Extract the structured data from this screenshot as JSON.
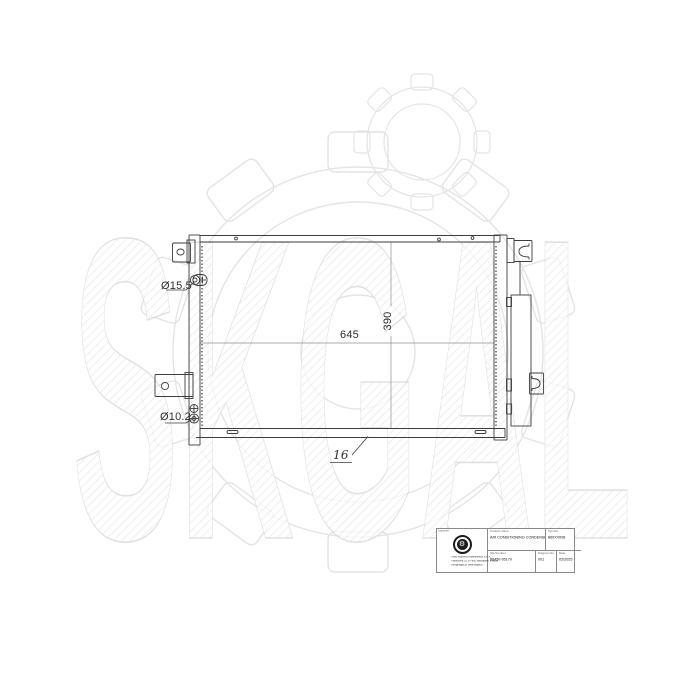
{
  "watermark": {
    "text": "SKGAL",
    "hatch_color": "#e2e2e2",
    "outline_color": "#dadada",
    "gear_icon": "gear-outline-watermark"
  },
  "drawing": {
    "type": "technical-line-drawing",
    "subject": "air conditioning condenser, front view",
    "line_color": "#3d3d3d",
    "labels": {
      "port_top_diameter": "Ø15.5",
      "port_bottom_diameter": "Ø10.2",
      "core_width": "645",
      "core_height": "390",
      "core_thickness": "16"
    }
  },
  "title_block": {
    "producer": {
      "header": "Importer",
      "logo_icon": "gear-badge-logo",
      "logo_glyph": "⚙",
      "company_lines": [
        "KMB Wojciech Adamkiewicz S.K.A.",
        "Fabryczna 25, 87-800 Włocławek, Poland",
        "info@skgal.pl, www.skgal.pl"
      ]
    },
    "product": {
      "header": "Product name",
      "value": "AIR CONDITIONING CONDENSER"
    },
    "symbol": {
      "header": "Symbol",
      "value": "860XV008"
    },
    "oe_number": {
      "header": "OE Number",
      "value": "88450-05170"
    },
    "diagram_no": {
      "header": "Diagram No.",
      "value": "001"
    },
    "date": {
      "header": "Date",
      "value": "02/2025"
    }
  }
}
